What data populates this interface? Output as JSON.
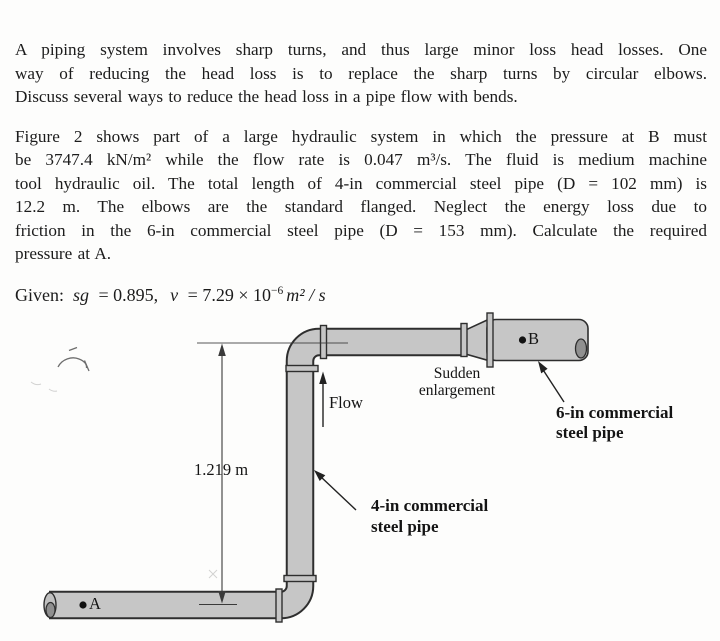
{
  "text": {
    "p1_lines": [
      "A piping system involves sharp turns, and thus large minor loss head losses. One",
      "way of reducing the head loss is to replace the sharp turns by circular elbows.",
      "Discuss several ways to reduce the head loss in a pipe flow with bends."
    ],
    "p2_lines": [
      "Figure 2 shows part of a large hydraulic system in which the pressure at B must",
      "be 3747.4 kN/m² while the flow rate is 0.047 m³/s. The fluid is medium machine",
      "tool hydraulic oil. The total length of 4-in commercial steel pipe (D = 102 mm) is",
      "12.2 m. The elbows are the standard flanged. Neglect the energy loss due to",
      "friction in the 6-in commercial steel pipe (D = 153 mm). Calculate the required",
      "pressure at A."
    ],
    "given": {
      "label": "Given:",
      "sg": "sg",
      "eq1": "= 0.895,",
      "nu": "v",
      "eq2": "= 7.29 × 10",
      "exp": "−6",
      "unit": "m² / s"
    }
  },
  "diagram": {
    "labels": {
      "flow": "Flow",
      "sudden_enlargement": "Sudden\nenlargement",
      "pipe6": "6-in commercial\nsteel pipe",
      "pipe4": "4-in commercial\nsteel pipe",
      "dimension": "1.219 m",
      "point_a": "A",
      "point_b": "B"
    },
    "colors": {
      "pipe_fill": "#c6c6c6",
      "pipe_outline": "#2e2e2e",
      "line": "#3a3a3a"
    }
  }
}
